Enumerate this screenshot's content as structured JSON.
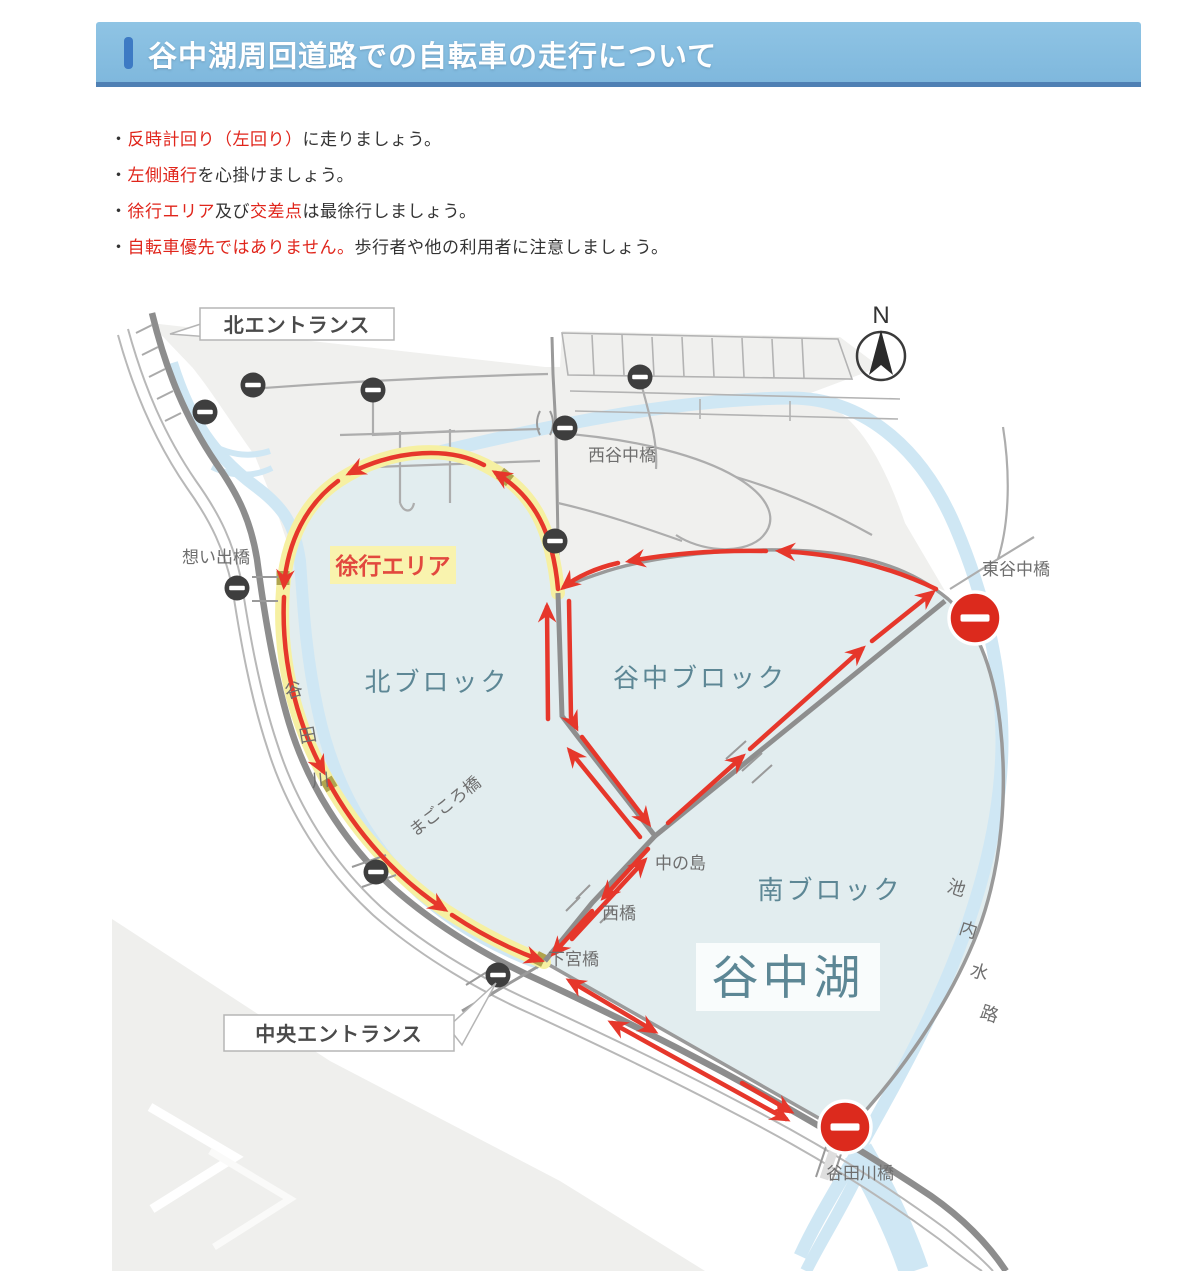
{
  "header": {
    "title": "谷中湖周回道路での自転車の走行について",
    "bar_color": "#7fb8dd",
    "border_color": "#4f80b4",
    "accent_color": "#3d7ac4"
  },
  "bullets": [
    {
      "segments": [
        {
          "text": "・",
          "color": "#333333"
        },
        {
          "text": "反時計回り（左回り）",
          "color": "#e0251b"
        },
        {
          "text": "に走りましょう。",
          "color": "#333333"
        }
      ]
    },
    {
      "segments": [
        {
          "text": "・",
          "color": "#333333"
        },
        {
          "text": "左側通行",
          "color": "#e0251b"
        },
        {
          "text": "を心掛けましょう。",
          "color": "#333333"
        }
      ]
    },
    {
      "segments": [
        {
          "text": "・",
          "color": "#333333"
        },
        {
          "text": "徐行エリア",
          "color": "#e0251b"
        },
        {
          "text": "及び",
          "color": "#333333"
        },
        {
          "text": "交差点",
          "color": "#e0251b"
        },
        {
          "text": "は最徐行しましょう。",
          "color": "#333333"
        }
      ]
    },
    {
      "segments": [
        {
          "text": "・",
          "color": "#333333"
        },
        {
          "text": "自転車優先ではありません。",
          "color": "#e0251b"
        },
        {
          "text": "歩行者や他の利用者に注意しましょう。",
          "color": "#333333"
        }
      ]
    }
  ],
  "map": {
    "compass_label": "N",
    "callouts": {
      "north_entrance": "北エントランス",
      "central_entrance": "中央エントランス"
    },
    "slow_area_label": "徐行エリア",
    "lake_label": "谷中湖",
    "blocks": {
      "north": "北ブロック",
      "yanaka": "谷中ブロック",
      "south": "南ブロック"
    },
    "bridges": {
      "nishi_yanaka": "西谷中橋",
      "higashi_yanaka": "東谷中橋",
      "omoide": "想い出橋",
      "magokoro": "まごころ橋",
      "nakanoshima": "中の島",
      "nishi": "西橋",
      "shimomiya": "下宮橋",
      "yatagawa_bridge": "谷田川橋"
    },
    "waterways": {
      "yatagawa": [
        "谷",
        "田",
        "川"
      ],
      "ikenai_suiro": [
        "池",
        "内",
        "水",
        "路"
      ]
    },
    "colors": {
      "route_arrow": "#e6372b",
      "slow_band": "#f6f0a2",
      "lake": "#e2edef",
      "land": "#f0f0ee",
      "water": "#cfe7f4",
      "road": "#919191",
      "no_entry_red": "#dc2a1d",
      "no_entry_dark": "#3e3e3e",
      "block_label": "#5d8795"
    }
  }
}
